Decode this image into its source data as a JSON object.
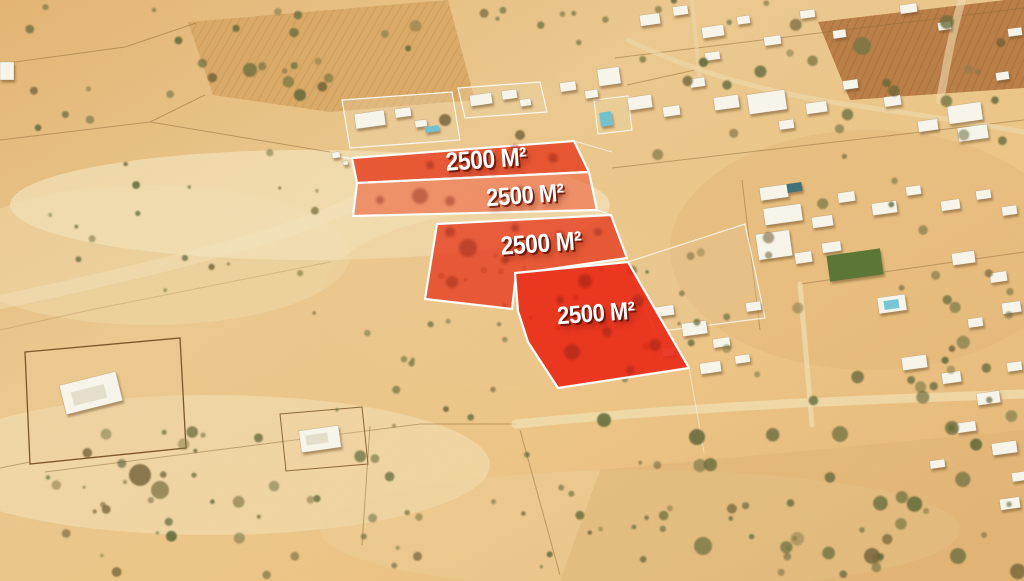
{
  "overlay": {
    "line_color": "#ffffff",
    "label_color": "#ffffff",
    "parcels": [
      {
        "label": "2500 M²",
        "points": [
          [
            352,
            158
          ],
          [
            574,
            141
          ],
          [
            589,
            172
          ],
          [
            357,
            183
          ]
        ],
        "fill": "#e7421f",
        "opacity": 0.87,
        "label_x": 486,
        "label_y": 159,
        "label_size": 26,
        "label_rotate": -4
      },
      {
        "label": "2500 M²",
        "points": [
          [
            357,
            183
          ],
          [
            589,
            172
          ],
          [
            597,
            210
          ],
          [
            353,
            216
          ]
        ],
        "fill": "#ef5a36",
        "opacity": 0.6,
        "label_x": 525,
        "label_y": 196,
        "label_size": 25,
        "label_rotate": -4
      },
      {
        "label": "2500 M²",
        "points": [
          [
            437,
            224
          ],
          [
            611,
            215
          ],
          [
            627,
            258
          ],
          [
            516,
            274
          ],
          [
            512,
            309
          ],
          [
            425,
            299
          ]
        ],
        "fill": "#e73d20",
        "opacity": 0.82,
        "label_x": 541,
        "label_y": 243,
        "label_size": 26,
        "label_rotate": -4
      },
      {
        "label": "2500 M²",
        "points": [
          [
            515,
            273
          ],
          [
            628,
            262
          ],
          [
            689,
            368
          ],
          [
            558,
            388
          ],
          [
            528,
            342
          ],
          [
            518,
            311
          ]
        ],
        "fill": "#ea2410",
        "opacity": 0.9,
        "label_x": 596,
        "label_y": 314,
        "label_size": 25,
        "label_rotate": -4
      }
    ]
  }
}
